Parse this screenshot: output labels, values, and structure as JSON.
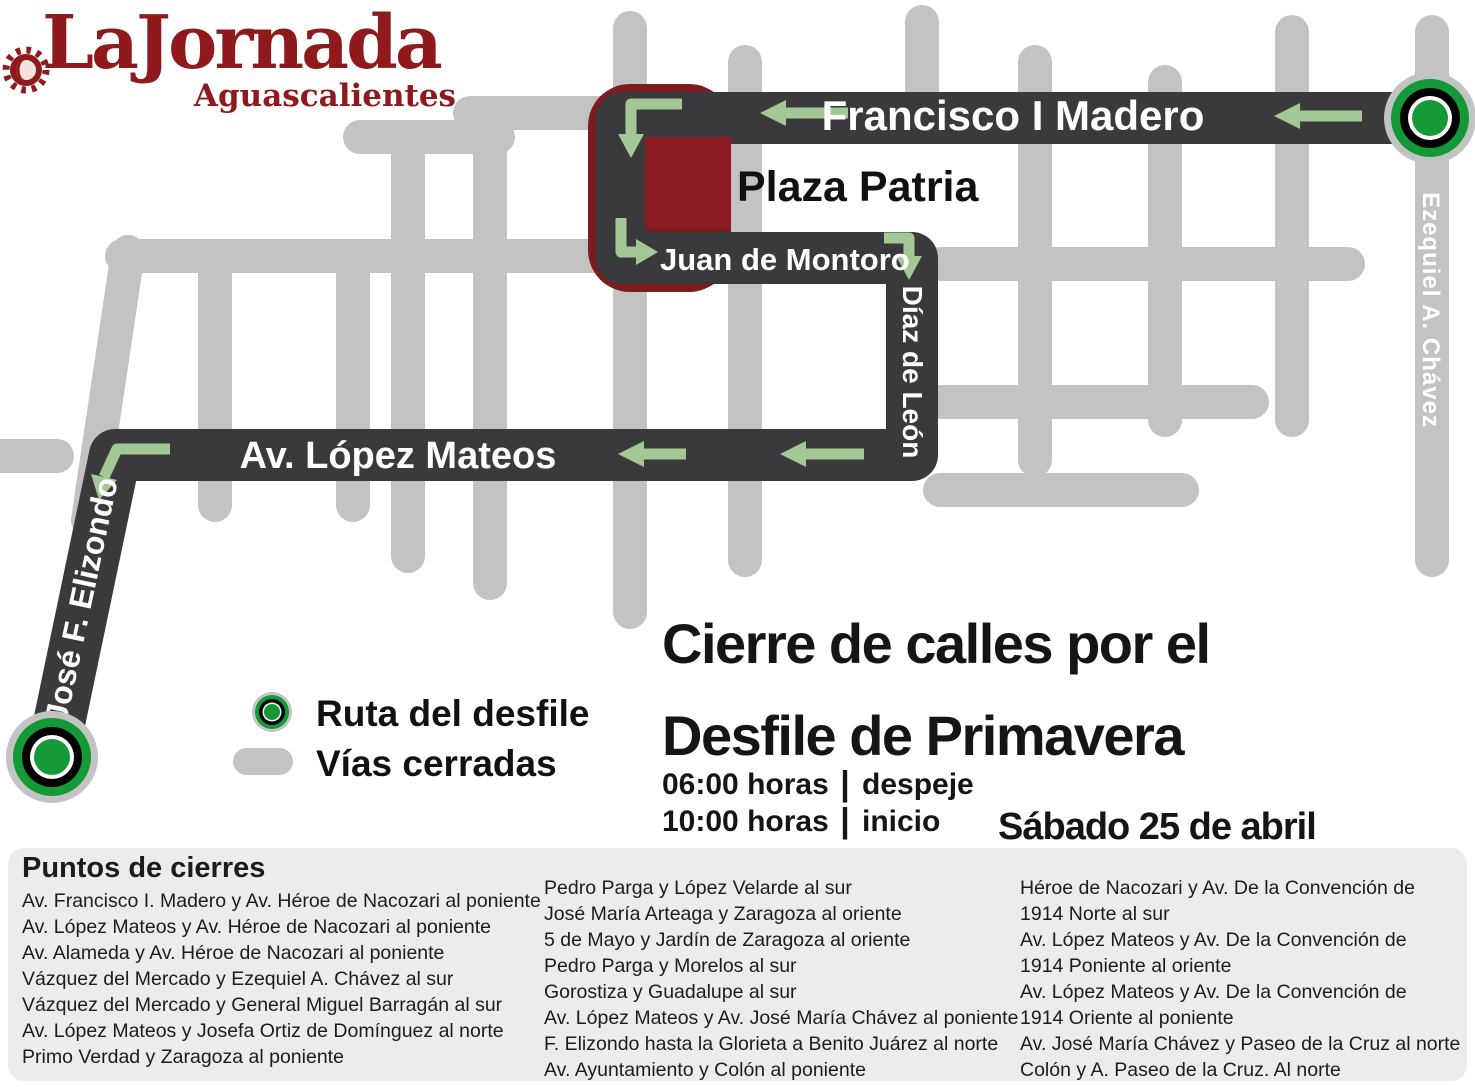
{
  "logo": {
    "title": "LaJornada",
    "subtitle": "Aguascalientes"
  },
  "map": {
    "streets": {
      "madero": "Francisco I Madero",
      "montoro": "Juan de Montoro",
      "diaz_de_leon": "Díaz de León",
      "lopez_mateos": "Av. López Mateos",
      "elizondo": "José F. Elizondo",
      "ezequiel_chavez": "Ezequiel A. Chávez",
      "plaza": "Plaza Patria"
    }
  },
  "legend": {
    "route_label": "Ruta del desfile",
    "closed_label": "Vías cerradas"
  },
  "headline": {
    "line1": "Cierre de calles por el",
    "line2": "Desfile de Primavera"
  },
  "schedule": [
    {
      "time": "06:00 horas",
      "label": "despeje"
    },
    {
      "time": "10:00 horas",
      "label": "inicio"
    }
  ],
  "schedule_separator": "|",
  "date": "Sábado 25 de abril",
  "closures": {
    "heading": "Puntos de cierres",
    "col1": [
      "Av. Francisco I. Madero y Av. Héroe de Nacozari al poniente",
      "Av. López Mateos y Av. Héroe de Nacozari al poniente",
      "Av. Alameda y Av. Héroe de Nacozari al poniente",
      "Vázquez del Mercado y Ezequiel  A. Chávez al sur",
      "Vázquez del Mercado y General Miguel Barragán al sur",
      "Av. López Mateos y Josefa Ortiz de Domínguez al norte",
      "Primo Verdad y Zaragoza al poniente"
    ],
    "col2": [
      "Pedro Parga y López Velarde  al sur",
      "José María Arteaga y Zaragoza al oriente",
      "5 de Mayo y Jardín de Zaragoza al oriente",
      "Pedro Parga y Morelos al sur",
      "Gorostiza y Guadalupe al sur",
      "Av. López Mateos y Av. José María Chávez al poniente",
      "F. Elizondo hasta la Glorieta a Benito Juárez al norte",
      "Av. Ayuntamiento y Colón al poniente"
    ],
    "col3": [
      "Héroe de Nacozari y Av. De la Convención de",
      "1914 Norte al sur",
      "Av. López Mateos y Av. De la Convención de",
      "1914 Poniente al oriente",
      "Av. López Mateos y Av. De la Convención de",
      "1914 Oriente al poniente",
      "Av. José María Chávez y Paseo de la Cruz al norte",
      "Colón y A. Paseo de la Cruz. Al norte"
    ]
  },
  "colors": {
    "brand_red": "#8e1a1e",
    "route_dark": "#3a3a3c",
    "closed_road_gray": "#c3c3c3",
    "arrow_green": "#a3c896",
    "marker_green": "#139a36",
    "plaza_red": "#8d1b23",
    "plaza_outline_red": "#7c1b20",
    "panel_gray": "#ececec"
  }
}
